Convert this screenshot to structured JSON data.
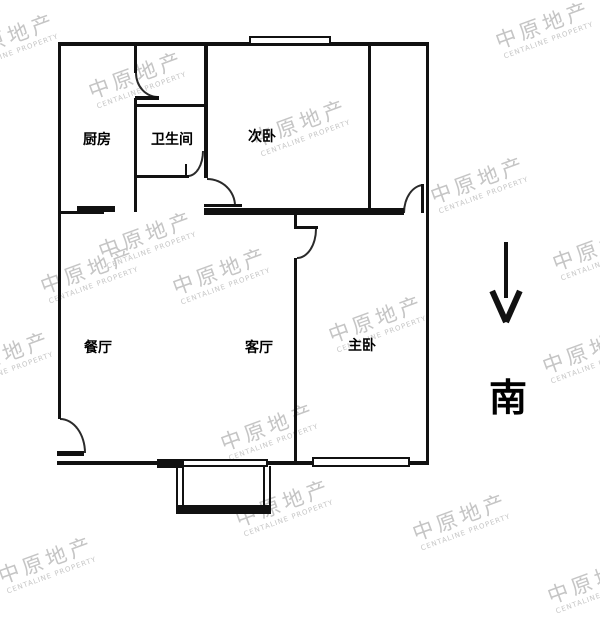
{
  "watermark": {
    "text": "中原地产",
    "subtext": "CENTALINE PROPERTY"
  },
  "compass": {
    "south_label": "南"
  },
  "rooms": [
    {
      "name": "kitchen",
      "label": "厨房"
    },
    {
      "name": "bathroom",
      "label": "卫生间"
    },
    {
      "name": "secondary-bedroom",
      "label": "次卧"
    },
    {
      "name": "dining-room",
      "label": "餐厅"
    },
    {
      "name": "living-room",
      "label": "客厅"
    },
    {
      "name": "master-bedroom",
      "label": "主卧"
    }
  ]
}
